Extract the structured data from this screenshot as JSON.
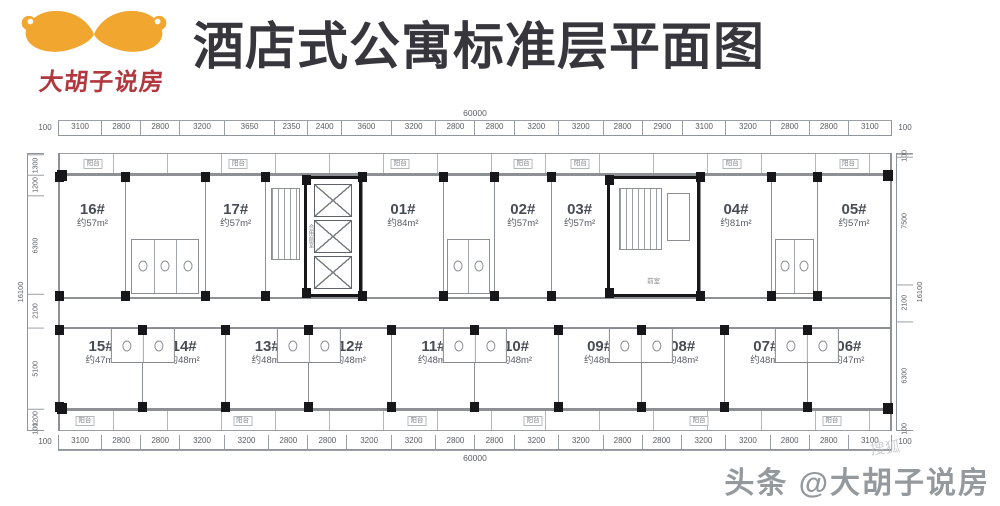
{
  "header": {
    "logo_text": "大胡子说房",
    "title": "酒店式公寓标准层平面图"
  },
  "colors": {
    "accent_orange": "#F0A62F",
    "logo_red": "#B1383F",
    "title_dark": "#36363C",
    "wall_gray": "#8D9196",
    "wall_black": "#17171A",
    "dim_text": "#5A5E63",
    "watermark_gray": "#94999D"
  },
  "dimensions": {
    "top": {
      "total": "60000",
      "left_cap": "100",
      "right_cap": "100",
      "segments": [
        "3100",
        "2800",
        "2800",
        "3200",
        "3650",
        "2350",
        "2400",
        "3600",
        "3200",
        "2800",
        "2800",
        "3200",
        "3200",
        "2800",
        "2900",
        "3100",
        "3200",
        "2800",
        "2800",
        "3100"
      ]
    },
    "bottom": {
      "total": "60000",
      "left_cap": "100",
      "right_cap": "100",
      "segments": [
        "3100",
        "2800",
        "2800",
        "3200",
        "3200",
        "2800",
        "2800",
        "3200",
        "3200",
        "2800",
        "2800",
        "3200",
        "3200",
        "2800",
        "2800",
        "3200",
        "3200",
        "2800",
        "2800",
        "3100"
      ]
    },
    "left": {
      "total": "16100",
      "segments": [
        "1300",
        "1200",
        "6300",
        "2100",
        "5100",
        "1200",
        "100"
      ]
    },
    "right": {
      "total": "16100",
      "segments": [
        "100",
        "7500",
        "2100",
        "6300",
        "100"
      ]
    }
  },
  "plan": {
    "balcony_label": "阳台",
    "core_labels": {
      "shared_lobby": "合用前室",
      "front_room": "前室"
    },
    "top_rooms": [
      {
        "no": "16#",
        "area": "约57m²"
      },
      {
        "no": "17#",
        "area": "约57m²"
      },
      {
        "no": "01#",
        "area": "约84m²"
      },
      {
        "no": "02#",
        "area": "约57m²"
      },
      {
        "no": "03#",
        "area": "约57m²"
      },
      {
        "no": "04#",
        "area": "约81m²"
      },
      {
        "no": "05#",
        "area": "约57m²"
      }
    ],
    "bottom_rooms": [
      {
        "no": "15#",
        "area": "约47m²"
      },
      {
        "no": "14#",
        "area": "约48m²"
      },
      {
        "no": "13#",
        "area": "约48m²"
      },
      {
        "no": "12#",
        "area": "约48m²"
      },
      {
        "no": "11#",
        "area": "约48m²"
      },
      {
        "no": "10#",
        "area": "约48m²"
      },
      {
        "no": "09#",
        "area": "约48m²"
      },
      {
        "no": "08#",
        "area": "约48m²"
      },
      {
        "no": "07#",
        "area": "约48m²"
      },
      {
        "no": "06#",
        "area": "约47m²"
      }
    ]
  },
  "watermark": {
    "text": "头条 @大胡子说房",
    "ghost": "搜狐"
  }
}
